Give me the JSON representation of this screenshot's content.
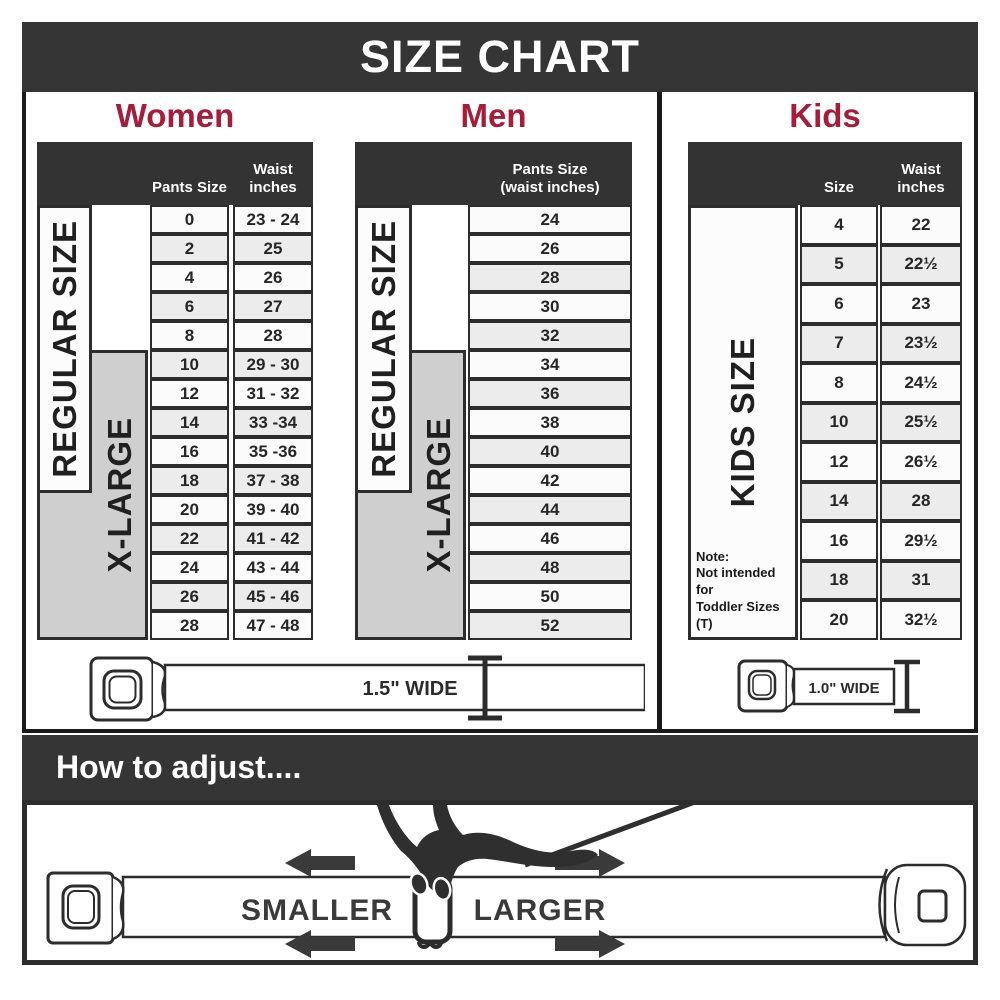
{
  "title": "SIZE CHART",
  "colors": {
    "accent_crimson": "#a71c39",
    "bar_charcoal": "#353535",
    "table_border": "#2d2d2d",
    "xlarge_fill": "#cfcfcf",
    "row_alt": "#ececec"
  },
  "sections": {
    "women": {
      "heading": "Women",
      "header": {
        "col1": "Pants Size",
        "col2_line1": "Waist",
        "col2_line2": "inches"
      },
      "regular_label": "REGULAR SIZE",
      "xlarge_label": "X-LARGE"
    },
    "men": {
      "heading": "Men",
      "header": {
        "line1": "Pants Size",
        "line2": "(waist inches)"
      },
      "regular_label": "REGULAR SIZE",
      "xlarge_label": "X-LARGE"
    },
    "kids": {
      "heading": "Kids",
      "header": {
        "col1": "Size",
        "col2_line1": "Waist",
        "col2_line2": "inches"
      },
      "side_label": "KIDS SIZE",
      "note": {
        "title": "Note:",
        "line1": "Not intended for",
        "line2": "Toddler Sizes (T)"
      }
    }
  },
  "belts": {
    "adult_width_label": "1.5\" WIDE",
    "kids_width_label": "1.0\" WIDE"
  },
  "adjust": {
    "heading": "How to adjust....",
    "smaller_label": "SMALLER",
    "larger_label": "LARGER"
  },
  "chart_data": [
    {
      "type": "table",
      "title": "Women",
      "columns": [
        "Pants Size",
        "Waist inches"
      ],
      "rows": [
        [
          "0",
          "23 - 24"
        ],
        [
          "2",
          "25"
        ],
        [
          "4",
          "26"
        ],
        [
          "6",
          "27"
        ],
        [
          "8",
          "28"
        ],
        [
          "10",
          "29 - 30"
        ],
        [
          "12",
          "31 - 32"
        ],
        [
          "14",
          "33 -34"
        ],
        [
          "16",
          "35 -36"
        ],
        [
          "18",
          "37 - 38"
        ],
        [
          "20",
          "39 - 40"
        ],
        [
          "22",
          "41 - 42"
        ],
        [
          "24",
          "43 - 44"
        ],
        [
          "26",
          "45 - 46"
        ],
        [
          "28",
          "47 - 48"
        ]
      ],
      "row_groups": [
        {
          "label": "REGULAR SIZE",
          "covers_sizes": "0-18"
        },
        {
          "label": "X-LARGE",
          "covers_sizes": "10-28"
        }
      ]
    },
    {
      "type": "table",
      "title": "Men",
      "columns": [
        "Pants Size (waist inches)"
      ],
      "rows": [
        [
          "24"
        ],
        [
          "26"
        ],
        [
          "28"
        ],
        [
          "30"
        ],
        [
          "32"
        ],
        [
          "34"
        ],
        [
          "36"
        ],
        [
          "38"
        ],
        [
          "40"
        ],
        [
          "42"
        ],
        [
          "44"
        ],
        [
          "46"
        ],
        [
          "48"
        ],
        [
          "50"
        ],
        [
          "52"
        ]
      ],
      "row_groups": [
        {
          "label": "REGULAR SIZE",
          "covers_sizes": "24-42"
        },
        {
          "label": "X-LARGE",
          "covers_sizes": "34-52"
        }
      ]
    },
    {
      "type": "table",
      "title": "Kids",
      "columns": [
        "Size",
        "Waist inches"
      ],
      "rows": [
        [
          "4",
          "22"
        ],
        [
          "5",
          "22½"
        ],
        [
          "6",
          "23"
        ],
        [
          "7",
          "23½"
        ],
        [
          "8",
          "24½"
        ],
        [
          "10",
          "25½"
        ],
        [
          "12",
          "26½"
        ],
        [
          "14",
          "28"
        ],
        [
          "16",
          "29½"
        ],
        [
          "18",
          "31"
        ],
        [
          "20",
          "32½"
        ]
      ],
      "note": "Not intended for Toddler Sizes (T)"
    }
  ]
}
